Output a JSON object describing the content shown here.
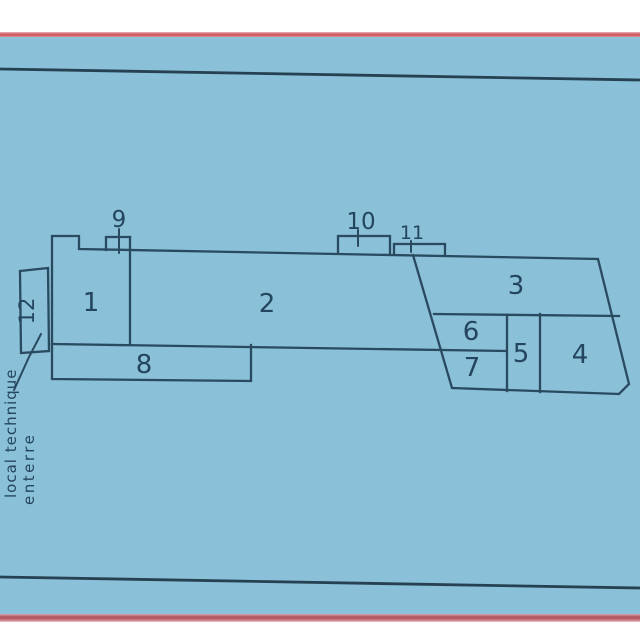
{
  "plan": {
    "rooms": {
      "r1": "1",
      "r2": "2",
      "r3": "3",
      "r4": "4",
      "r5": "5",
      "r6": "6",
      "r7": "7",
      "r8": "8",
      "r12": "12"
    },
    "roof_structures": {
      "s9": "9",
      "s10": "10",
      "s11": "11"
    },
    "annotation": {
      "line1": "local technique",
      "line2": "enterre"
    }
  },
  "colors": {
    "background_blue": "#8ac0d8",
    "ink": "#2a4a60",
    "border_red": "#c9545f",
    "page_white": "#ffffff"
  }
}
